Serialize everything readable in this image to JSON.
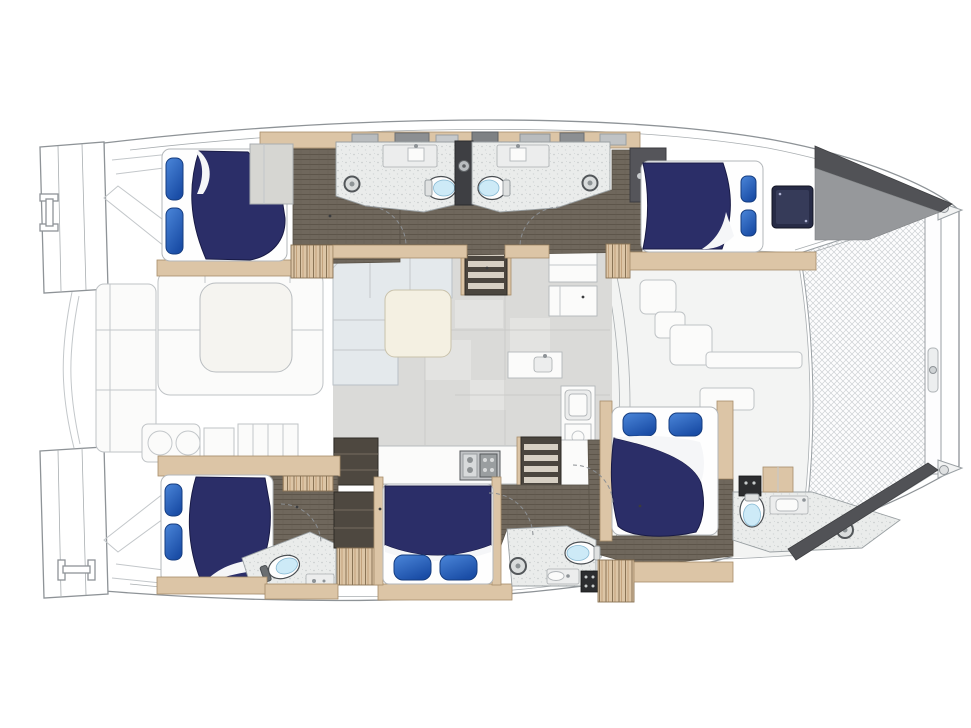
{
  "meta": {
    "type": "diagram",
    "subtype": "yacht-floorplan",
    "vessel": "sailing-catamaran",
    "view": "top-down-deck-plan",
    "orientation_bow": "right",
    "visible_text": "none"
  },
  "palette": {
    "background": "#ffffff",
    "hull_line": "#8e9397",
    "bed_navy": "#2b2e68",
    "pillow_light": "#4b86d9",
    "pillow_dark": "#1a4da6",
    "mattress_white": "#fefefe",
    "wood": "#dcc5a6",
    "floor_dark": "#6f675c",
    "bath_floor": "#eaeceb",
    "salon_floor": "#dadad8",
    "sofa_gray": "#e4e9ec",
    "table_cream": "#f4f0e2",
    "steps_dark": "#4a453e",
    "bow_dark": "#515256",
    "bow_mid": "#96989b",
    "toilet_seat": "#cdeaf7",
    "tv_navy": "#272b46",
    "net_line": "#cdd1d4"
  },
  "features": {
    "cabins": [
      {
        "id": "port-aft",
        "bed": "island-double",
        "pillows": 2,
        "bedding": "navy-duvet"
      },
      {
        "id": "port-forward",
        "bed": "island-double",
        "pillows": 2,
        "bedding": "navy-duvet"
      },
      {
        "id": "starboard-aft",
        "bed": "island-double",
        "pillows": 2,
        "bedding": "navy-duvet"
      },
      {
        "id": "starboard-mid",
        "bed": "double",
        "pillows": 2,
        "bedding": "navy-duvet"
      },
      {
        "id": "starboard-forward",
        "bed": "island-double",
        "pillows": 2,
        "bedding": "navy-duvet"
      }
    ],
    "heads": [
      {
        "id": "port-aft-head",
        "toilet": true,
        "sink": true,
        "shower_drain": true
      },
      {
        "id": "port-forward-head",
        "toilet": true,
        "sink": true,
        "shower_drain": true
      },
      {
        "id": "starboard-aft-head",
        "toilet": true,
        "sink": true,
        "shower_drain": false
      },
      {
        "id": "starboard-mid-head",
        "toilet": true,
        "sink": true,
        "shower_drain": true
      },
      {
        "id": "starboard-forward-head",
        "toilet": true,
        "sink": true,
        "shower_drain": true
      }
    ],
    "salon": {
      "sofa": "L-shaped",
      "coffee_table": true,
      "companionway_steps": 2,
      "galley": {
        "stove_burners": 4,
        "sinks": 2,
        "refrigerator": true
      }
    },
    "aft_cockpit": {
      "table": true,
      "bench_seating": true,
      "wet_bar_sinks": 2,
      "stern_rail": true
    },
    "foredeck": {
      "trampoline": true,
      "seating": true,
      "forward_crossbeam": true
    },
    "stern": {
      "transom_platforms": 2,
      "cleats": 2,
      "transom_steps": true
    }
  }
}
